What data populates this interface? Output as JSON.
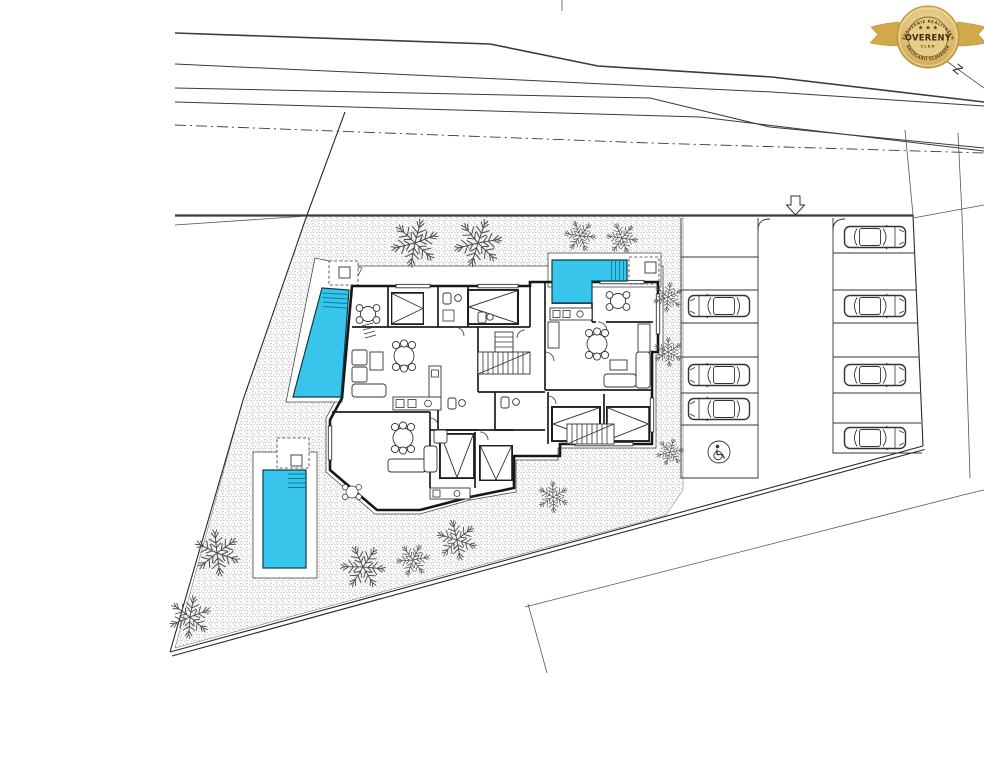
{
  "document": {
    "type": "architectural-site-plan",
    "description": "Ground-floor site plan of a 4-unit residence with pools, gardens and parking",
    "canvas": {
      "width": 984,
      "height": 768
    }
  },
  "badge": {
    "arc_top": "ZDRUŽENIE REALITNÝCH",
    "arc_bottom": "KANCELÁRIÍ SLOVENSKA",
    "stars": "★ ★ ★",
    "title": "OVERENÝ",
    "subtitle": "ČLEN",
    "colors": {
      "ribbon": "#d2a84d",
      "medal_face": "#e7cd87",
      "medal_edge": "#b8902f",
      "text_dark": "#3d2d06"
    }
  },
  "site": {
    "orientation_mark": "Z",
    "pool_color": "#38c5ec",
    "pools": [
      {
        "id": "pool-west",
        "shape": "slanted trapezoid with steps"
      },
      {
        "id": "pool-north",
        "shape": "L-shape with steps"
      },
      {
        "id": "pool-south",
        "shape": "rectangle with steps"
      }
    ],
    "apartment_units": 4,
    "trees": {
      "large": 6,
      "small": 7
    },
    "parking": {
      "entrance_arrow": "down",
      "left_column": {
        "stalls": 7,
        "cars": 3,
        "accessible_stall": 1
      },
      "right_column": {
        "stalls": 7,
        "cars": 4
      }
    }
  }
}
